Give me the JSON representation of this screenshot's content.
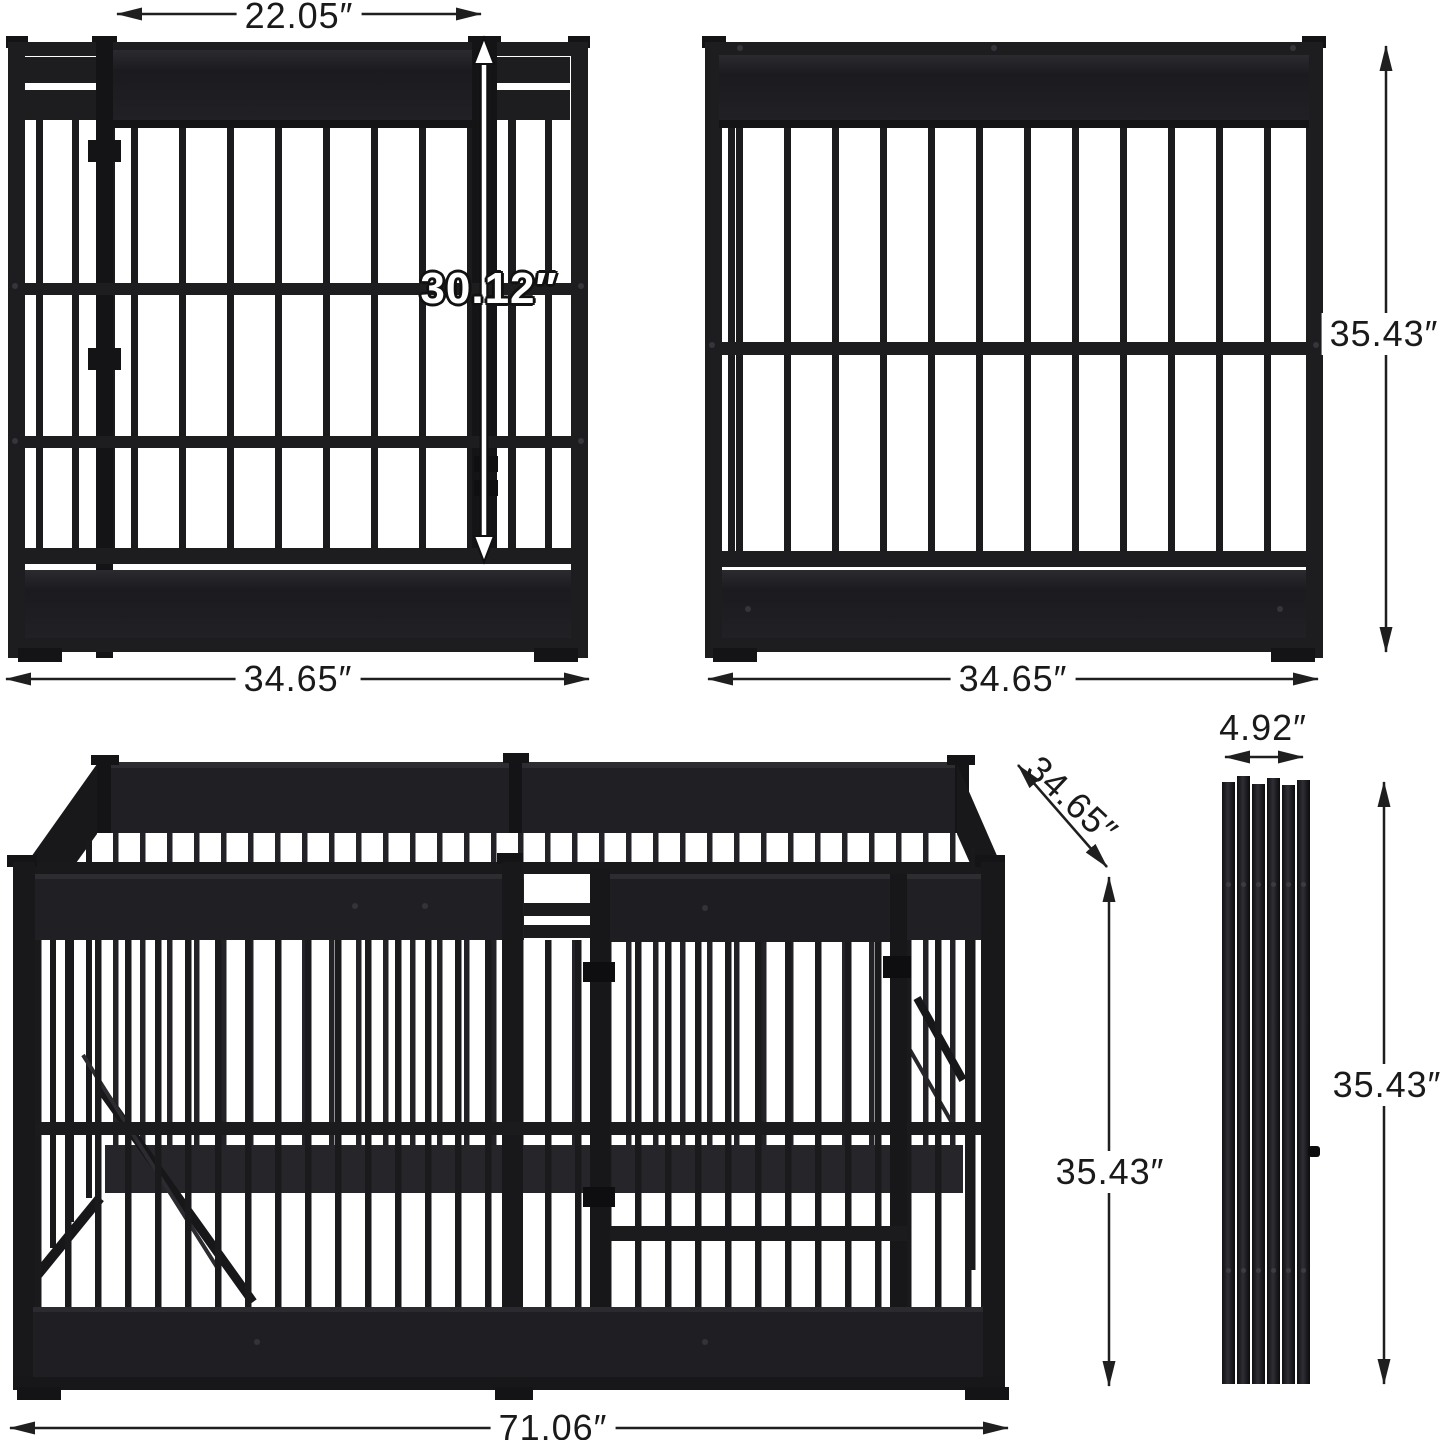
{
  "diagram": {
    "front_panel": {
      "gate_width": "22.05″",
      "gate_height": "30.12″",
      "width": "34.65″"
    },
    "side_panel": {
      "width": "34.65″",
      "height": "35.43″"
    },
    "assembled_pen": {
      "depth": "34.65″",
      "height": "35.43″",
      "width": "71.06″"
    },
    "folded_stack": {
      "thickness": "4.92″",
      "height": "35.43″"
    }
  },
  "style": {
    "background": "#ffffff",
    "metal": "#1d1d20",
    "metal_dark": "#141417",
    "label_color": "#1a1a1a"
  }
}
